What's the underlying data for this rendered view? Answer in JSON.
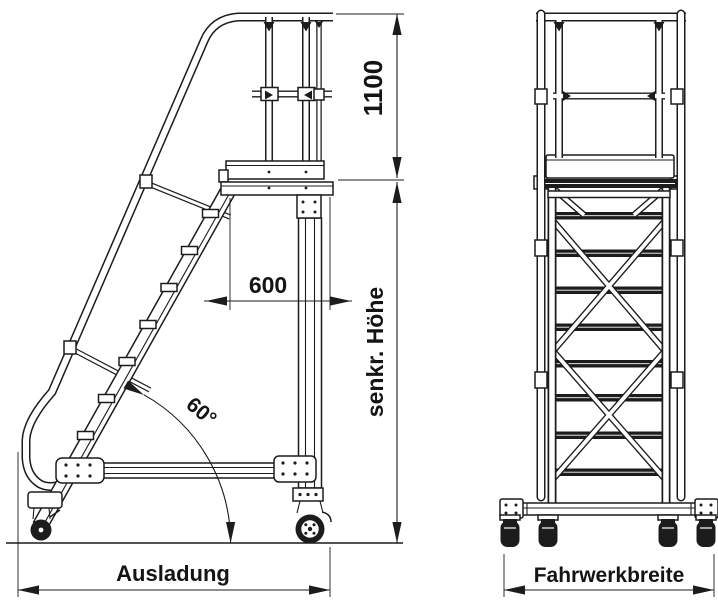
{
  "drawing": {
    "type": "technical-drawing",
    "subject": "mobile platform stairway, side view and front view",
    "background_color": "#ffffff",
    "line_color": "#1c1c1c",
    "labels": {
      "guardrail_height": "1100",
      "platform_depth": "600",
      "stair_angle": "60°",
      "vertical_height": "senkr. Höhe",
      "overhang": "Ausladung",
      "chassis_width": "Fahrwerkbreite"
    }
  }
}
